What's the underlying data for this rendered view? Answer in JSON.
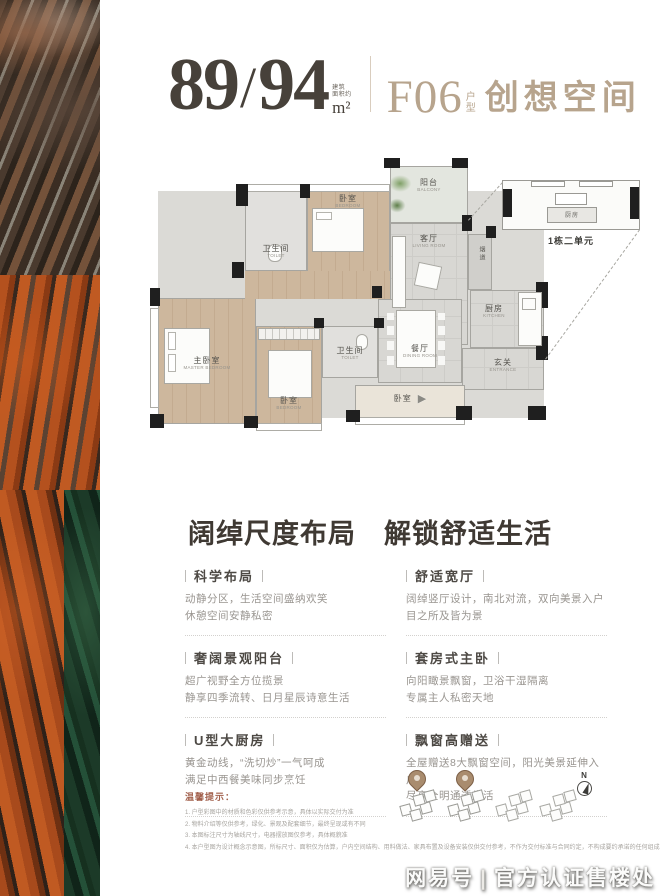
{
  "colors": {
    "accent_tan": "#b7a48d",
    "heading_dark": "#47413a",
    "tip_red": "#a2604c",
    "wood_floor": "#cdb79d",
    "art_orange": "#b4511e",
    "art_green": "#1c3a28"
  },
  "header": {
    "area_left": "89",
    "slash": "/",
    "area_right": "94",
    "area_note_line1": "建筑",
    "area_note_line2": "面积约",
    "area_unit": "m²",
    "unit_code": "F06",
    "unit_code_suffix": "户型",
    "unit_name": "创想空间"
  },
  "floorplan": {
    "rooms": [
      {
        "zh": "卫生间",
        "en": "TOILET"
      },
      {
        "zh": "卧室",
        "en": "BEDROOM"
      },
      {
        "zh": "阳台",
        "en": "BALCONY"
      },
      {
        "zh": "客厅",
        "en": "LIVING ROOM"
      },
      {
        "zh": "厨房",
        "en": "KITCHEN"
      },
      {
        "zh": "玄关",
        "en": "ENTRANCE"
      },
      {
        "zh": "餐厅",
        "en": "DINING ROOM"
      },
      {
        "zh": "主卧室",
        "en": "MASTER BEDROOM"
      },
      {
        "zh": "卧室",
        "en": "BEDROOM"
      },
      {
        "zh": "卫生间",
        "en": "TOILET"
      },
      {
        "zh": "卧室",
        "en": "BEDROOM"
      }
    ],
    "flue_label": "烟道",
    "inset_room": "厨房",
    "inset_caption": "1栋二单元"
  },
  "headline": "阔绰尺度布局　解锁舒适生活",
  "features": [
    {
      "title": "科学布局",
      "lines": [
        "动静分区，生活空间盛纳欢笑",
        "休憩空间安静私密"
      ]
    },
    {
      "title": "舒适宽厅",
      "lines": [
        "阔绰竖厅设计，南北对流，双向美景入户",
        "目之所及皆为景"
      ]
    },
    {
      "title": "奢阔景观阳台",
      "lines": [
        "超广视野全方位揽景",
        "静享四季流转、日月星辰诗意生活"
      ]
    },
    {
      "title": "套房式主卧",
      "lines": [
        "向阳瞰景飘窗，卫浴干湿隔离",
        "专属主人私密天地"
      ]
    },
    {
      "title": "U型大厨房",
      "lines": [
        "黄金动线，“洗切炒”一气呵成",
        "满足中西餐美味同步烹饪"
      ]
    },
    {
      "title": "飘窗高赠送",
      "lines": [
        "全屋赠送8大飘窗空间，阳光美景延伸入户",
        "尽享全明通透生活"
      ]
    }
  ],
  "tips": {
    "title": "温馨提示：",
    "lines": [
      "1. 户型彩图中的材质和色彩仅供参考示意，具体以实际交付为准",
      "2. 物料介绍等仅供参考，绿化、景观及配套细节，最终呈现或有不同",
      "3. 本图标注尺寸为轴线尺寸，电器摆放图仅参考，具体概貌准",
      "4. 本户型图为设计概念示意图，所标尺寸、面积仅为估算，户内空间结构、用料做法、家具布置及设备安装仅供交付参考，不作为交付标准与合同约定，不构成要约承诺的任何组成与依据，解释不同处，以上，扩建"
    ]
  },
  "icons": {
    "compass_n": "N",
    "entry_arrow": "▶"
  },
  "watermark": {
    "brand": "网易号",
    "divider": "|",
    "text": "官方认证售楼处"
  }
}
